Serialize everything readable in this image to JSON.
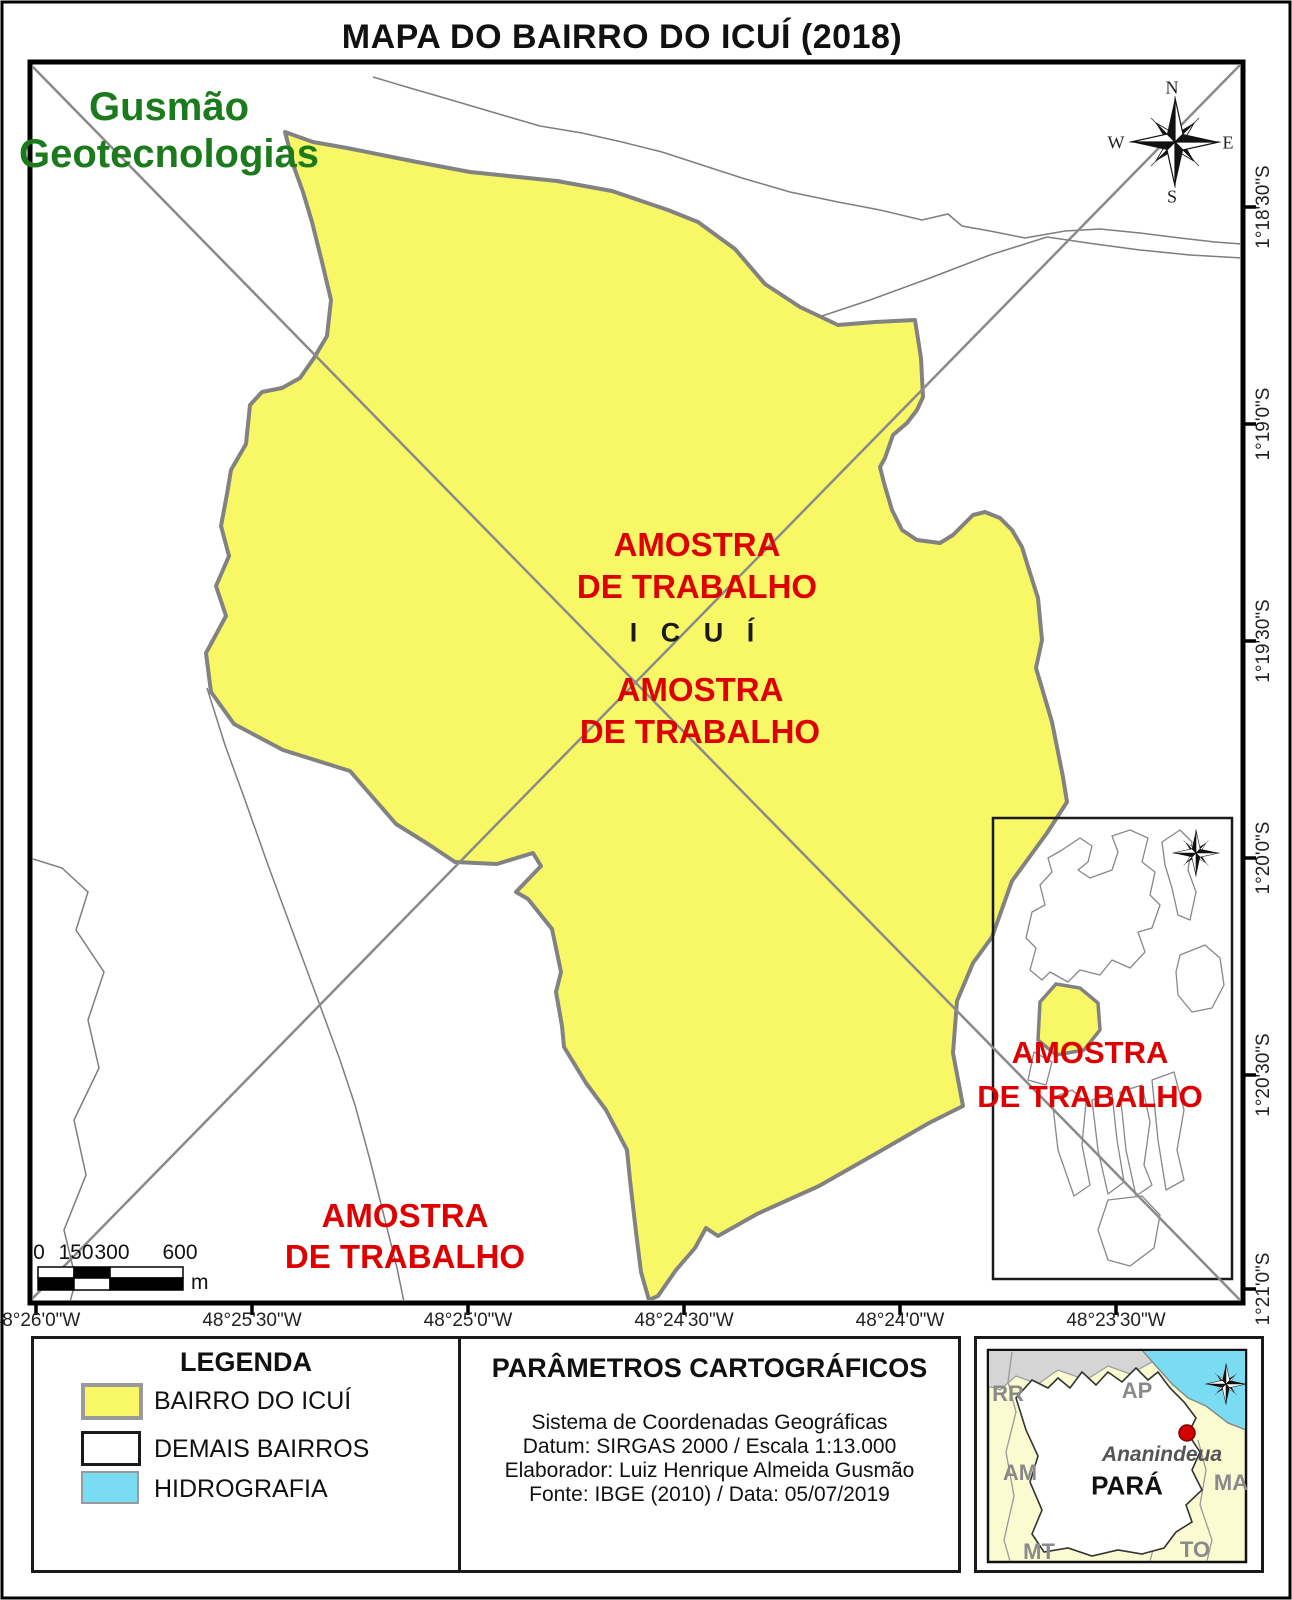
{
  "title": "MAPA DO BAIRRO DO ICUÍ (2018)",
  "brand": {
    "line1": "Gusmão",
    "line2": "Geotecnologias"
  },
  "watermark": {
    "line1": "AMOSTRA",
    "line2": "DE TRABALHO"
  },
  "map": {
    "area_label": "I C U Í",
    "compass": {
      "north": "N",
      "east": "E",
      "south": "S",
      "west": "W"
    },
    "lat_labels": [
      "1°18'30\"S",
      "1°19'0\"S",
      "1°19'30\"S",
      "1°20'0\"S",
      "1°20'30\"S",
      "1°21'0\"S"
    ],
    "lon_labels": [
      "48°26'0\"W",
      "48°25'30\"W",
      "48°25'0\"W",
      "48°24'30\"W",
      "48°24'0\"W",
      "48°23'30\"W"
    ],
    "scalebar": {
      "ticks": [
        "0",
        "150",
        "300",
        "600"
      ],
      "unit": "m"
    }
  },
  "legend": {
    "title": "LEGENDA",
    "items": [
      {
        "label": "BAIRRO DO ICUÍ",
        "color": "#F8F866"
      },
      {
        "label": "DEMAIS BAIRROS",
        "color": "#FFFFFF"
      },
      {
        "label": "HIDROGRAFIA",
        "color": "#79DCF2"
      }
    ]
  },
  "cartographic_params": {
    "title": "PARÂMETROS CARTOGRÁFICOS",
    "lines": [
      "Sistema de Coordenadas Geográficas",
      "Datum: SIRGAS 2000 / Escala 1:13.000",
      "Elaborador: Luiz Henrique Almeida Gusmão",
      "Fonte: IBGE (2010) / Data: 05/07/2019"
    ]
  },
  "para_inset": {
    "state": "PARÁ",
    "city": "Ananindeua",
    "neighbors": {
      "rr": "RR",
      "ap": "AP",
      "am": "AM",
      "ma": "MA",
      "mt": "MT",
      "to": "TO"
    }
  },
  "colors": {
    "bairro_fill": "#F8F866",
    "boundary_gray": "#828282",
    "watermark_red": "#DE0000",
    "brand_green": "#1B7A1B",
    "water_cyan": "#79DCF2",
    "neighbor_state_fill": "#FBFBD2",
    "foreign_area_fill": "#D5D5D5"
  }
}
